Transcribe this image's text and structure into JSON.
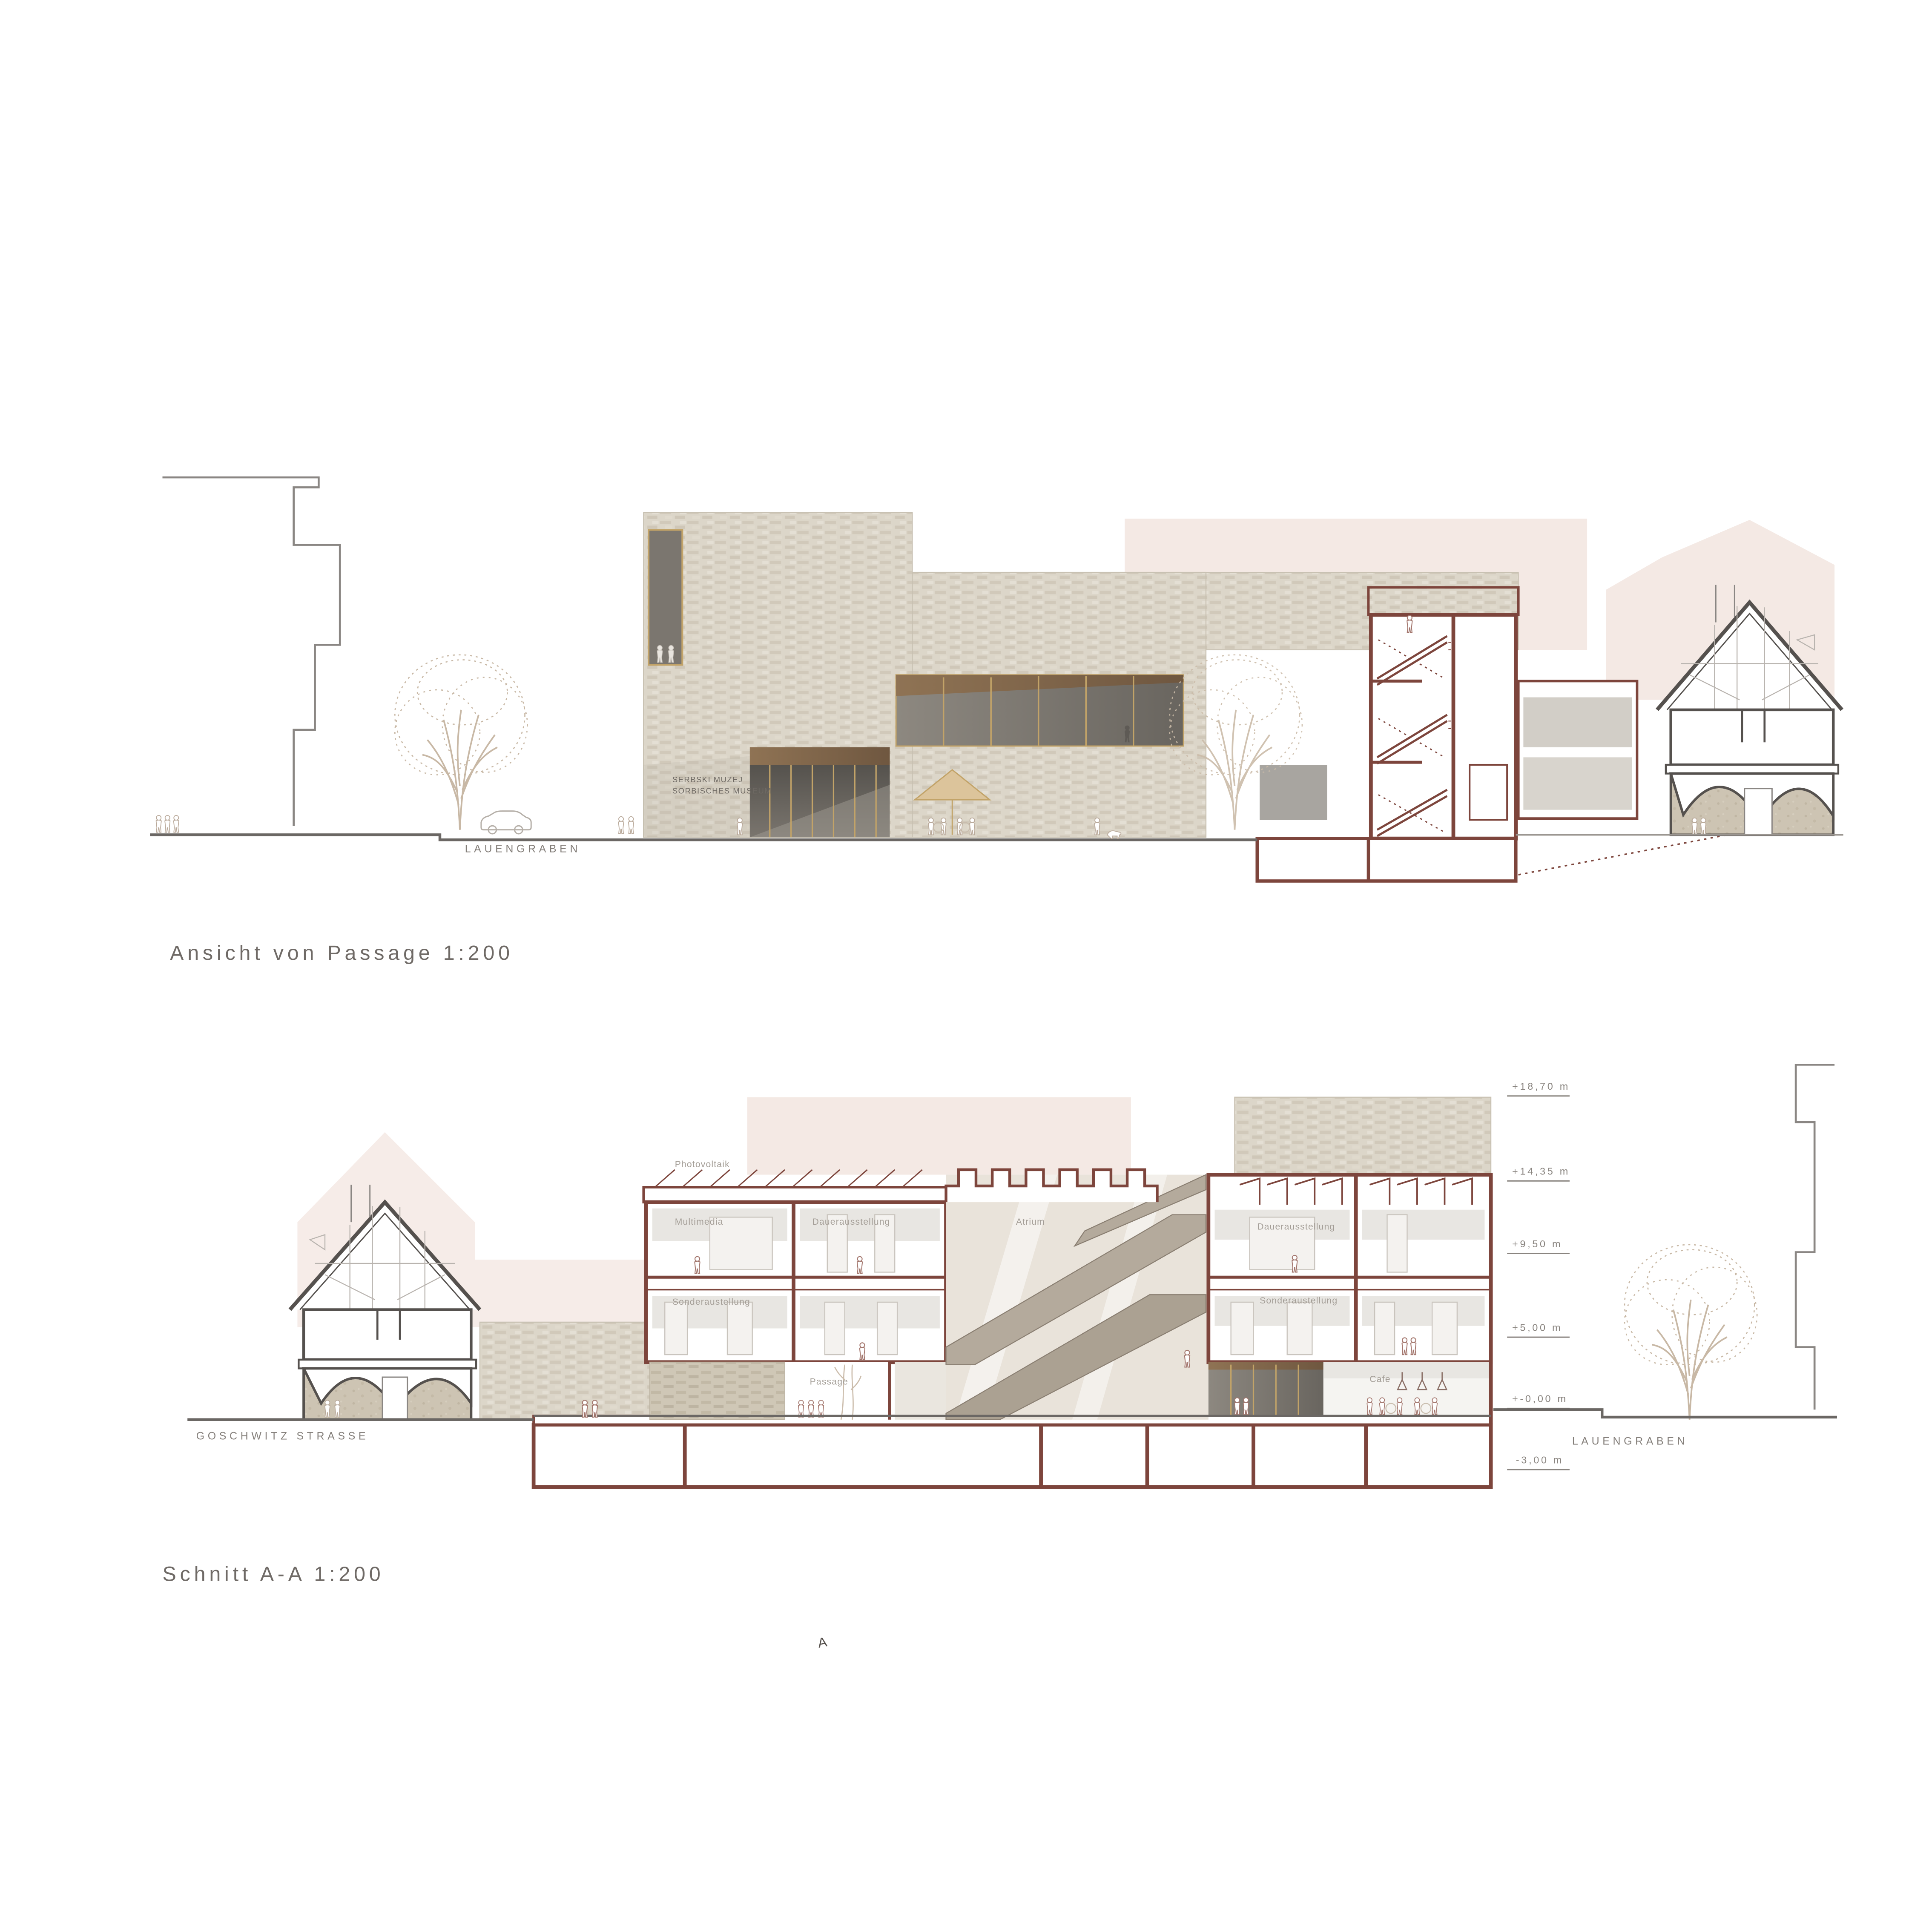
{
  "titles": {
    "elevation": "Ansicht von Passage 1:200",
    "section": "Schnitt A-A  1:200"
  },
  "streets": {
    "top": "LAUENGRABEN",
    "goschwitz": "GOSCHWITZ STRASSE",
    "lauengraben_bottom": "LAUENGRABEN"
  },
  "museum_sign": {
    "line1": "SERBSKI MUZEJ",
    "line2": "SORBISCHES MUSEUM"
  },
  "rooms": {
    "photovoltaik": "Photovoltaik",
    "multimedia": "Multimedia",
    "dauer_left": "Dauerausstellung",
    "sonder_left": "Sonderaustellung",
    "passage": "Passage",
    "atrium": "Atrium",
    "dauer_right": "Dauerausstellung",
    "sonder_right": "Sonderaustellung",
    "cafe": "Cafe"
  },
  "elevation_marks": [
    "+18,70 m",
    "+14,35 m",
    "+9,50 m",
    "+5,00 m",
    "+-0,00 m",
    "-3,00 m"
  ],
  "marker": {
    "a": "A"
  },
  "colors": {
    "section_line": "#7d453c",
    "house_section_line": "#55514e",
    "brick": "#dcd6c9",
    "vault_plaster": "#cdc4b3",
    "wood": "#7d6348",
    "glass_dark": "#6e6a63",
    "mullion_tan": "#c2a368",
    "background_pink": "#f4e9e4",
    "tree_line": "#c8b8a5",
    "ground_line": "#6b6764",
    "label_gray": "#8a8580"
  }
}
